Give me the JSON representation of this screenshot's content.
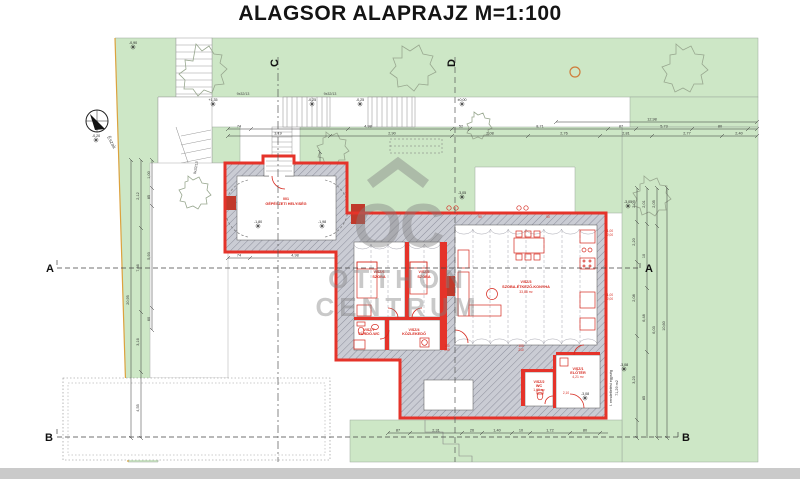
{
  "title": "ALAGSOR ALAPRAJZ M=1:100",
  "watermark": {
    "logo": "OC",
    "line1": "OTTHON",
    "line2": "CENTRUM"
  },
  "north": {
    "label": "Észak"
  },
  "sections": {
    "a": "A",
    "b": "B",
    "c": "C",
    "d": "D"
  },
  "rooms": [
    {
      "id": "001",
      "name": "GÉPÉSZETI HELYISÉG",
      "area": ""
    },
    {
      "id": "V/SZ/6",
      "name": "SZOBA",
      "area": ""
    },
    {
      "id": "V/SZ/5",
      "name": "SZOBA",
      "area": ""
    },
    {
      "id": "V/SZ/7",
      "name": "FÜRDŐ-WC",
      "area": ""
    },
    {
      "id": "V/SZ/4",
      "name": "KÖZLEKEDŐ",
      "area": ""
    },
    {
      "id": "V/SZ/3",
      "name": "SZOBA-ÉTKEZŐ-KONYHA",
      "area": "33,88 m²"
    },
    {
      "id": "V/SZ/2",
      "name": "WC",
      "area": "1,60 m²"
    },
    {
      "id": "V/SZ/1",
      "name": "ELŐTÉR",
      "area": "4,21 m²"
    }
  ],
  "notes": {
    "stairs1": "9x32/13",
    "stairs2": "9x32/13",
    "stairs3": "9x32/13",
    "unit_line1": "I. rendeltetési egység",
    "unit_line2": "71,29 m2"
  },
  "elevations": [
    {
      "x": 133,
      "y": 47,
      "t": "-0,90"
    },
    {
      "x": 96,
      "y": 140,
      "t": "-0,20"
    },
    {
      "x": 213,
      "y": 104,
      "t": "+1,35"
    },
    {
      "x": 312,
      "y": 104,
      "t": "-0,25"
    },
    {
      "x": 360,
      "y": 104,
      "t": "-0,25"
    },
    {
      "x": 462,
      "y": 104,
      "t": "±0,00"
    },
    {
      "x": 628,
      "y": 206,
      "t": "-3,05"
    },
    {
      "x": 462,
      "y": 197,
      "t": "-3,05"
    },
    {
      "x": 258,
      "y": 226,
      "t": "-1,80"
    },
    {
      "x": 322,
      "y": 226,
      "t": "-1,98"
    },
    {
      "x": 624,
      "y": 369,
      "t": "-3,08"
    },
    {
      "x": 585,
      "y": 398,
      "t": "-3,08"
    }
  ],
  "door_labels": [
    {
      "x": 447,
      "y": 347,
      "t": "100"
    },
    {
      "x": 447,
      "y": 351,
      "t": "210"
    },
    {
      "x": 610,
      "y": 232,
      "t": "1,00"
    },
    {
      "x": 610,
      "y": 236,
      "t": "2,00"
    },
    {
      "x": 610,
      "y": 296,
      "t": "1,00"
    },
    {
      "x": 610,
      "y": 300,
      "t": "2,00"
    },
    {
      "x": 521,
      "y": 347,
      "t": "100"
    },
    {
      "x": 521,
      "y": 351,
      "t": "210"
    },
    {
      "x": 566,
      "y": 394,
      "t": "2,10"
    },
    {
      "x": 480,
      "y": 218,
      "t": "90"
    },
    {
      "x": 548,
      "y": 218,
      "t": "90"
    }
  ],
  "dims": {
    "chains": [
      {
        "dir": "h",
        "pos": 122,
        "from": 556,
        "to": 757,
        "ticks": [
          556,
          757
        ],
        "labels": [
          {
            "p": 652,
            "t": "12,98"
          }
        ]
      },
      {
        "dir": "h",
        "pos": 129,
        "from": 228,
        "to": 757,
        "ticks": [
          228,
          251,
          348,
          452,
          470,
          608,
          636,
          692,
          748,
          757
        ],
        "labels": [
          {
            "p": 239,
            "t": "74"
          },
          {
            "p": 368,
            "t": "4,98"
          },
          {
            "p": 461,
            "t": "52"
          },
          {
            "p": 540,
            "t": "8,71"
          },
          {
            "p": 621,
            "t": "87"
          },
          {
            "p": 664,
            "t": "5,73"
          },
          {
            "p": 720,
            "t": "80"
          }
        ]
      },
      {
        "dir": "h",
        "pos": 136,
        "from": 228,
        "to": 757,
        "ticks": [
          228,
          330,
          452,
          528,
          600,
          652,
          722,
          757
        ],
        "labels": [
          {
            "p": 278,
            "t": "3,19"
          },
          {
            "p": 392,
            "t": "2,90"
          },
          {
            "p": 490,
            "t": "2,08"
          },
          {
            "p": 564,
            "t": "2,76"
          },
          {
            "p": 626,
            "t": "2,81"
          },
          {
            "p": 687,
            "t": "2,77"
          },
          {
            "p": 739,
            "t": "2,40"
          }
        ]
      },
      {
        "dir": "h",
        "pos": 433,
        "from": 388,
        "to": 608,
        "ticks": [
          388,
          410,
          462,
          482,
          512,
          530,
          570,
          600
        ],
        "labels": [
          {
            "p": 398,
            "t": "87"
          },
          {
            "p": 436,
            "t": "2,31"
          },
          {
            "p": 472,
            "t": "26"
          },
          {
            "p": 497,
            "t": "1,40"
          },
          {
            "p": 521,
            "t": "10"
          },
          {
            "p": 550,
            "t": "1,72"
          },
          {
            "p": 585,
            "t": "80"
          }
        ]
      },
      {
        "dir": "h",
        "pos": 258,
        "from": 228,
        "to": 345,
        "ticks": [
          228,
          250,
          340
        ],
        "labels": [
          {
            "p": 239,
            "t": "74"
          },
          {
            "p": 295,
            "t": "4,98"
          }
        ]
      },
      {
        "dir": "v",
        "pos": 131,
        "from": 160,
        "to": 438,
        "ticks": [
          160,
          438
        ],
        "labels": [
          {
            "p": 300,
            "t": "20,95"
          }
        ]
      },
      {
        "dir": "v",
        "pos": 141,
        "from": 160,
        "to": 438,
        "ticks": [
          160,
          228,
          312,
          372,
          438
        ],
        "labels": [
          {
            "p": 196,
            "t": "2,12"
          },
          {
            "p": 268,
            "t": "7,36"
          },
          {
            "p": 342,
            "t": "3,16"
          },
          {
            "p": 408,
            "t": "4,55"
          }
        ]
      },
      {
        "dir": "v",
        "pos": 152,
        "from": 160,
        "to": 330,
        "ticks": [
          160,
          188,
          206,
          308,
          330
        ],
        "labels": [
          {
            "p": 175,
            "t": "1,00"
          },
          {
            "p": 197,
            "t": "85"
          },
          {
            "p": 256,
            "t": "5,93"
          },
          {
            "p": 319,
            "t": "60"
          }
        ]
      },
      {
        "dir": "v",
        "pos": 320,
        "from": 152,
        "to": 250,
        "ticks": [
          152,
          176,
          208,
          246
        ],
        "labels": [
          {
            "p": 190,
            "t": "1,02"
          },
          {
            "p": 227,
            "t": "2,12"
          }
        ]
      },
      {
        "dir": "v",
        "pos": 637,
        "from": 188,
        "to": 438,
        "ticks": [
          188,
          222,
          262,
          336,
          420,
          438
        ],
        "labels": [
          {
            "p": 204,
            "t": "2,05"
          },
          {
            "p": 242,
            "t": "2,20"
          },
          {
            "p": 298,
            "t": "2,08"
          },
          {
            "p": 380,
            "t": "3,23"
          }
        ]
      },
      {
        "dir": "v",
        "pos": 647,
        "from": 188,
        "to": 438,
        "ticks": [
          188,
          224,
          288,
          352
        ],
        "labels": [
          {
            "p": 204,
            "t": "2,01"
          },
          {
            "p": 256,
            "t": "10"
          },
          {
            "p": 318,
            "t": "6,48"
          },
          {
            "p": 398,
            "t": "85"
          }
        ]
      },
      {
        "dir": "v",
        "pos": 657,
        "from": 188,
        "to": 438,
        "ticks": [
          188,
          226,
          438
        ],
        "labels": [
          {
            "p": 204,
            "t": "2,05"
          },
          {
            "p": 330,
            "t": "6,03"
          }
        ]
      },
      {
        "dir": "v",
        "pos": 667,
        "from": 188,
        "to": 438,
        "ticks": [
          188,
          438
        ],
        "labels": [
          {
            "p": 326,
            "t": "10,60"
          }
        ]
      }
    ]
  },
  "colors": {
    "site_green": "#cde7c6",
    "outline_red": "#e5332a",
    "label_red": "#d6281e",
    "wall_fill": "#caccd4",
    "hatch_line": "#8d8f9c",
    "boundary_orange": "#dca23e",
    "watermark_gray": "#7f7f7f",
    "scrollbar_gray": "#cacaca"
  }
}
